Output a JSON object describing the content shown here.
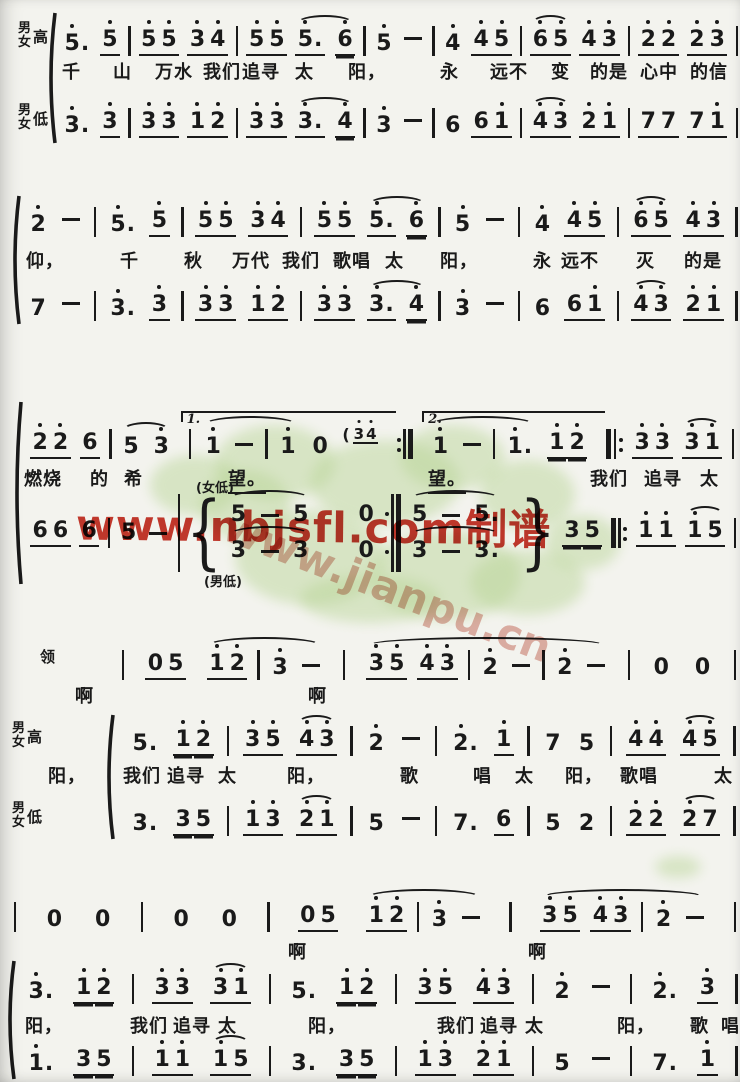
{
  "colors": {
    "ink": "#1a1a1a",
    "paper": "#f3f3ee",
    "red": "#c5281c",
    "pink": "#dfa79d",
    "green": "#b9d597"
  },
  "watermarks": {
    "red_text": "www.nbjsfl.com制谱",
    "diagonal_text": "www.jianpu.cn"
  },
  "blobs": [
    [
      150,
      455,
      90,
      60
    ],
    [
      215,
      425,
      120,
      75
    ],
    [
      310,
      440,
      150,
      85
    ],
    [
      400,
      425,
      105,
      65
    ],
    [
      480,
      460,
      95,
      70
    ],
    [
      235,
      510,
      150,
      95
    ],
    [
      370,
      530,
      150,
      90
    ],
    [
      300,
      575,
      140,
      48
    ],
    [
      470,
      550,
      115,
      65
    ],
    [
      545,
      515,
      75,
      55
    ],
    [
      200,
      470,
      90,
      70
    ],
    [
      655,
      856,
      46,
      22
    ]
  ],
  "systems": [
    {
      "top": 8,
      "h": 152,
      "bracket": {
        "x": 46,
        "y": 4,
        "h": 132
      },
      "lines": [
        {
          "type": "m",
          "y": 12,
          "x1": 62,
          "x2": 738,
          "label": {
            "stack": "男女",
            "side": "高",
            "x": 18
          },
          "tokens": [
            "5'.",
            "5'_",
            "|",
            "5'_5'_",
            "3'_4'_",
            "|",
            "5'_5'_",
            {
              "slur": [
                "5'_.",
                "6'="
              ]
            },
            "|",
            "5'",
            "-",
            "|",
            "4'",
            "4'_5'_",
            "|",
            {
              "slur": [
                "6'_5'_"
              ]
            },
            "4'_3'_",
            "|",
            "2'_2'_",
            "2'_3'_",
            "|"
          ]
        },
        {
          "type": "l",
          "y": 50,
          "items": [
            {
              "t": "千",
              "x": 62
            },
            {
              "t": "山",
              "x": 113
            },
            {
              "t": "万水",
              "x": 155
            },
            {
              "t": "我们",
              "x": 203
            },
            {
              "t": "追寻",
              "x": 242
            },
            {
              "t": "太",
              "x": 295
            },
            {
              "t": "阳，",
              "x": 348
            },
            {
              "t": "永",
              "x": 440
            },
            {
              "t": "远不",
              "x": 490
            },
            {
              "t": "变",
              "x": 551
            },
            {
              "t": "的是",
              "x": 590
            },
            {
              "t": "心中",
              "x": 640
            },
            {
              "t": "的信",
              "x": 690
            }
          ]
        },
        {
          "type": "m",
          "y": 94,
          "x1": 62,
          "x2": 738,
          "label": {
            "stack": "男女",
            "side": "低",
            "x": 18
          },
          "tokens": [
            "3'.",
            "3'_",
            "|",
            "3'_3'_",
            "1'_2'_",
            "|",
            "3'_3'_",
            {
              "slur": [
                "3'_.",
                "4'="
              ]
            },
            "|",
            "3'",
            "-",
            "|",
            "6",
            "6_1'_",
            "|",
            {
              "slur": [
                "4'_3'_"
              ]
            },
            "2'_1'_",
            "|",
            "7_7_",
            "7_1'_",
            "|"
          ]
        }
      ]
    },
    {
      "top": 193,
      "h": 142,
      "bracket": {
        "x": 10,
        "y": 2,
        "h": 130
      },
      "lines": [
        {
          "type": "m",
          "y": 8,
          "x1": 28,
          "x2": 738,
          "tokens": [
            "2'",
            "-",
            "|",
            "5'.",
            "5'_",
            "|",
            "5'_5'_",
            "3'_4'_",
            "|",
            "5'_5'_",
            {
              "slur": [
                "5'_.",
                "6'="
              ]
            },
            "|",
            "5'",
            "-",
            "|",
            "4'",
            "4'_5'_",
            "|",
            {
              "slur": [
                "6'_5'_"
              ]
            },
            "4'_3'_",
            "|"
          ]
        },
        {
          "type": "l",
          "y": 54,
          "items": [
            {
              "t": "仰，",
              "x": 26
            },
            {
              "t": "千",
              "x": 120
            },
            {
              "t": "秋",
              "x": 184
            },
            {
              "t": "万代",
              "x": 232
            },
            {
              "t": "我们",
              "x": 282
            },
            {
              "t": "歌唱",
              "x": 333
            },
            {
              "t": "太",
              "x": 385
            },
            {
              "t": "阳，",
              "x": 440
            },
            {
              "t": "永",
              "x": 533
            },
            {
              "t": "远不",
              "x": 561
            },
            {
              "t": "灭",
              "x": 636
            },
            {
              "t": "的是",
              "x": 684
            }
          ]
        },
        {
          "type": "m",
          "y": 92,
          "x1": 28,
          "x2": 738,
          "tokens": [
            "7",
            "-",
            "|",
            "3'.",
            "3'_",
            "|",
            "3'_3'_",
            "1'_2'_",
            "|",
            "3'_3'_",
            {
              "slur": [
                "3'_.",
                "4'="
              ]
            },
            "|",
            "3'",
            "-",
            "|",
            "6",
            "6_1'_",
            "|",
            {
              "slur": [
                "4'_3'_"
              ]
            },
            "2'_1'_",
            "|"
          ]
        }
      ]
    },
    {
      "top": 393,
      "h": 212,
      "bracket": {
        "x": 12,
        "y": 8,
        "h": 184
      },
      "annotations": [
        {
          "t": "(女低)",
          "x": 196,
          "y": 84
        },
        {
          "t": "(男低)",
          "x": 204,
          "y": 178
        }
      ],
      "lines": [
        {
          "type": "m",
          "y": 30,
          "x1": 30,
          "x2": 734,
          "tokens": [
            "2'_2'_",
            "6_",
            "|",
            {
              "slur": [
                "5",
                "3'"
              ]
            },
            {
              "volta": "1.",
              "t": [
                "|",
                {
                  "slur": [
                    "1'",
                    "-",
                    "|",
                    "1'"
                  ]
                },
                "0",
                {
                  "cue": [
                    "(",
                    "3'_4'_"
                  ]
                }
              ]
            },
            ":|",
            {
              "volta": "2.",
              "t": [
                {
                  "slur": [
                    "1'",
                    "-",
                    "|",
                    "1'."
                  ]
                },
                "1'=2'="
              ]
            },
            "|:",
            "3'_3'_",
            {
              "slur": [
                "3'_1'_"
              ]
            },
            "|"
          ]
        },
        {
          "type": "l",
          "y": 72,
          "items": [
            {
              "t": "燃烧",
              "x": 24
            },
            {
              "t": "的",
              "x": 90
            },
            {
              "t": "希",
              "x": 124
            },
            {
              "t": "望。",
              "x": 228,
              "u": true
            },
            {
              "t": "望。",
              "x": 428,
              "u": true
            },
            {
              "t": "我们",
              "x": 590
            },
            {
              "t": "追寻",
              "x": 644
            },
            {
              "t": "太",
              "x": 700
            }
          ]
        },
        {
          "type": "m",
          "y": 88,
          "x1": 30,
          "x2": 736,
          "mixed": true,
          "tokens": [
            "6_6_",
            "6_",
            "|",
            "5",
            "-",
            "|T",
            {
              "brace": "{"
            },
            {
              "stack": {
                "w": 148,
                "top": [
                  {
                    "slur": [
                      "5",
                      "-",
                      "5"
                    ]
                  },
                  "0"
                ],
                "bot": [
                  {
                    "slur": [
                      "3",
                      "-",
                      "3"
                    ]
                  },
                  "0"
                ]
              }
            },
            ":|T",
            {
              "stack": {
                "w": 104,
                "top": [
                  {
                    "slur": [
                      "5",
                      "-",
                      "5."
                    ]
                  }
                ],
                "bot": [
                  {
                    "slur": [
                      "3",
                      "-",
                      "3."
                    ]
                  }
                ]
              }
            },
            {
              "brace": "}"
            },
            "3=5=",
            "|:",
            "1'_1'_",
            {
              "slur": [
                "1'_5_"
              ]
            },
            "|"
          ]
        }
      ]
    },
    {
      "top": 618,
      "h": 232,
      "bracket": {
        "x": 104,
        "y": 96,
        "h": 126
      },
      "lines": [
        {
          "type": "m",
          "y": 26,
          "x1": 122,
          "x2": 736,
          "label": {
            "single": "领",
            "x": 40
          },
          "tokens": [
            "|",
            "0_5_",
            {
              "slur": [
                "1'_2'_",
                "|",
                "3'",
                "-"
              ]
            },
            "|",
            {
              "slur": [
                "3'_5'_",
                "4'_3'_",
                "|",
                "2'",
                "-",
                "|",
                "2'",
                "-"
              ]
            },
            "|",
            "0",
            "0",
            "|"
          ]
        },
        {
          "type": "l",
          "y": 64,
          "items": [
            {
              "t": "啊",
              "x": 75
            },
            {
              "t": "啊",
              "x": 308
            }
          ]
        },
        {
          "type": "m",
          "y": 102,
          "x1": 130,
          "x2": 736,
          "label": {
            "stack": "男女",
            "side": "高",
            "x": 12
          },
          "tokens": [
            "5.",
            "1'=2'=",
            "|",
            "3'_5'_",
            {
              "slur": [
                "4'_3'_"
              ]
            },
            "|",
            "2'",
            "-",
            "|",
            "2'.",
            "1'_",
            "|",
            "7",
            "5",
            "|",
            "4'_4'_",
            {
              "slur": [
                "4'_5'_"
              ]
            },
            "|"
          ]
        },
        {
          "type": "l",
          "y": 144,
          "items": [
            {
              "t": "阳，",
              "x": 48
            },
            {
              "t": "我们",
              "x": 123
            },
            {
              "t": "追寻",
              "x": 167
            },
            {
              "t": "太",
              "x": 218
            },
            {
              "t": "阳，",
              "x": 287
            },
            {
              "t": "歌",
              "x": 400
            },
            {
              "t": "唱",
              "x": 473
            },
            {
              "t": "太",
              "x": 515
            },
            {
              "t": "阳，",
              "x": 565
            },
            {
              "t": "歌唱",
              "x": 620
            },
            {
              "t": "太",
              "x": 714
            }
          ]
        },
        {
          "type": "m",
          "y": 182,
          "x1": 130,
          "x2": 736,
          "label": {
            "stack": "男女",
            "side": "低",
            "x": 12
          },
          "tokens": [
            "3.",
            "3=5=",
            "|",
            "1'_3'_",
            {
              "slur": [
                "2'_1'_"
              ]
            },
            "|",
            "5",
            "-",
            "|",
            "7.",
            "6_",
            "|",
            "5",
            "2",
            "|",
            "2'_2'_",
            {
              "slur": [
                "2'_7_"
              ]
            },
            "|"
          ]
        }
      ]
    },
    {
      "top": 856,
      "h": 226,
      "bracket": {
        "x": 5,
        "y": 104,
        "h": 120
      },
      "lines": [
        {
          "type": "m",
          "y": 40,
          "x1": 14,
          "x2": 736,
          "tokens": [
            "|",
            "0",
            "0",
            "|",
            "0",
            "0",
            "|",
            "0_5_",
            {
              "slur": [
                "1'_2'_",
                "|",
                "3'",
                "-"
              ]
            },
            "|",
            {
              "slur": [
                "3'_5'_",
                "4'_3'_",
                "|",
                "2'",
                "-"
              ]
            },
            "|"
          ]
        },
        {
          "type": "l",
          "y": 82,
          "items": [
            {
              "t": "啊",
              "x": 288
            },
            {
              "t": "啊",
              "x": 528
            }
          ]
        },
        {
          "type": "m",
          "y": 112,
          "x1": 26,
          "x2": 738,
          "tokens": [
            "3'.",
            "1'=2'=",
            "|",
            "3'_3'_",
            {
              "slur": [
                "3'_1'_"
              ]
            },
            "|",
            "5.",
            "1'=2'=",
            "|",
            "3'_5'_",
            "4'_3'_",
            "|",
            "2'",
            "-",
            "|",
            "2'.",
            "3'_",
            "|"
          ]
        },
        {
          "type": "l",
          "y": 156,
          "items": [
            {
              "t": "阳，",
              "x": 25
            },
            {
              "t": "我们",
              "x": 130
            },
            {
              "t": "追寻",
              "x": 173
            },
            {
              "t": "太",
              "x": 218
            },
            {
              "t": "阳，",
              "x": 308
            },
            {
              "t": "我们",
              "x": 437
            },
            {
              "t": "追寻",
              "x": 480
            },
            {
              "t": "太",
              "x": 525
            },
            {
              "t": "阳，",
              "x": 617
            },
            {
              "t": "歌",
              "x": 690
            },
            {
              "t": "唱",
              "x": 721
            }
          ]
        },
        {
          "type": "m",
          "y": 184,
          "x1": 26,
          "x2": 738,
          "tokens": [
            "1'.",
            "3=5=",
            "|",
            "1'_1'_",
            {
              "slur": [
                "1'_5_"
              ]
            },
            "|",
            "3.",
            "3=5=",
            "|",
            "1'_3'_",
            "2'_1'_",
            "|",
            "5",
            "-",
            "|",
            "7.",
            "1'_",
            "|"
          ]
        }
      ]
    }
  ]
}
